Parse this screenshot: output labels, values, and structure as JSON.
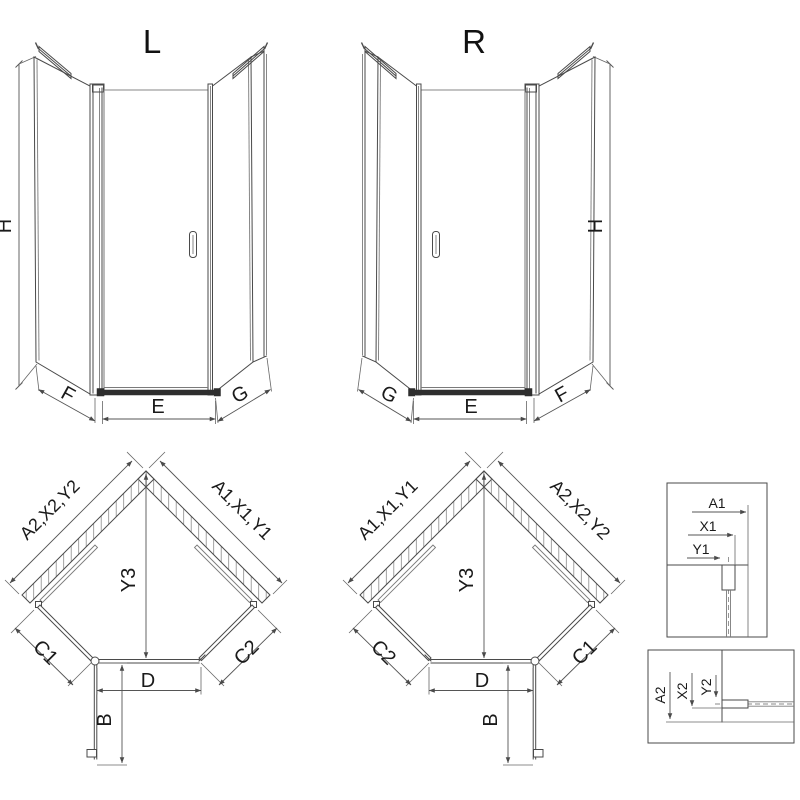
{
  "page": {
    "background_color": "#ffffff",
    "line_color": "#4a4a4a",
    "text_color": "#1a1a1a"
  },
  "front_left": {
    "title": "L",
    "height_label": "H",
    "left_panel_label": "F",
    "door_label": "E",
    "right_panel_label": "G"
  },
  "front_right": {
    "title": "R",
    "height_label": "H",
    "left_panel_label": "G",
    "door_label": "E",
    "right_panel_label": "F"
  },
  "plan_left": {
    "left_wall_label": "A2,X2,Y2",
    "right_wall_label": "A1,X1,Y1",
    "corner_depth_label": "Y3",
    "left_front_label": "C1",
    "right_front_label": "C2",
    "door_span_label": "D",
    "door_open_label": "B"
  },
  "plan_right": {
    "left_wall_label": "A1,X1,Y1",
    "right_wall_label": "A2,X2,Y2",
    "corner_depth_label": "Y3",
    "left_front_label": "C2",
    "right_front_label": "C1",
    "door_span_label": "D",
    "door_open_label": "B"
  },
  "detail_top": {
    "dim1": "A1",
    "dim2": "X1",
    "dim3": "Y1"
  },
  "detail_bottom": {
    "dim1": "A2",
    "dim2": "X2",
    "dim3": "Y2"
  }
}
